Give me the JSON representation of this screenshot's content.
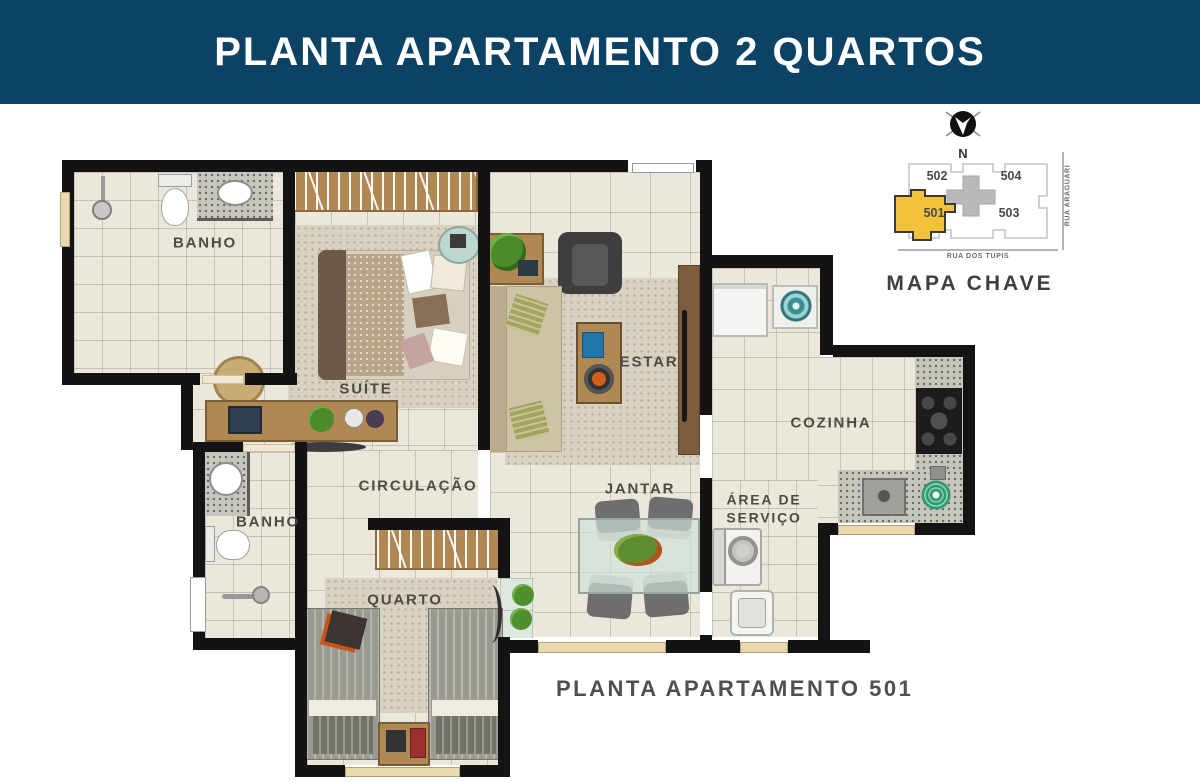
{
  "header": {
    "title": "PLANTA APARTAMENTO 2 QUARTOS",
    "bg_color": "#0c4264",
    "text_color": "#ffffff"
  },
  "caption": "PLANTA APARTAMENTO 501",
  "rooms": {
    "banho_suite": "BANHO",
    "suite": "SUÍTE",
    "estar": "ESTAR",
    "cozinha": "COZINHA",
    "circulacao": "CIRCULAÇÃO",
    "jantar": "JANTAR",
    "area_servico": "ÁREA DE SERVIÇO",
    "banho_social": "BANHO",
    "quarto": "QUARTO"
  },
  "key_map": {
    "title": "MAPA CHAVE",
    "compass": "N",
    "units": [
      {
        "number": "502",
        "highlighted": false
      },
      {
        "number": "504",
        "highlighted": false
      },
      {
        "number": "501",
        "highlighted": true
      },
      {
        "number": "503",
        "highlighted": false
      }
    ],
    "street_bottom": "RUA DOS TUPIS",
    "street_right": "RUA ARAGUARI",
    "highlight_color": "#f2c238"
  },
  "colors": {
    "header_bg": "#0c4264",
    "wall": "#131313",
    "floor_tile": "#ebe7da",
    "rug": "#d9d2c0",
    "wood": "#b08853",
    "granite": "#c6c6be",
    "label_text": "#4c4c45",
    "window": "#ead9ae",
    "highlight_unit": "#f2c238"
  }
}
